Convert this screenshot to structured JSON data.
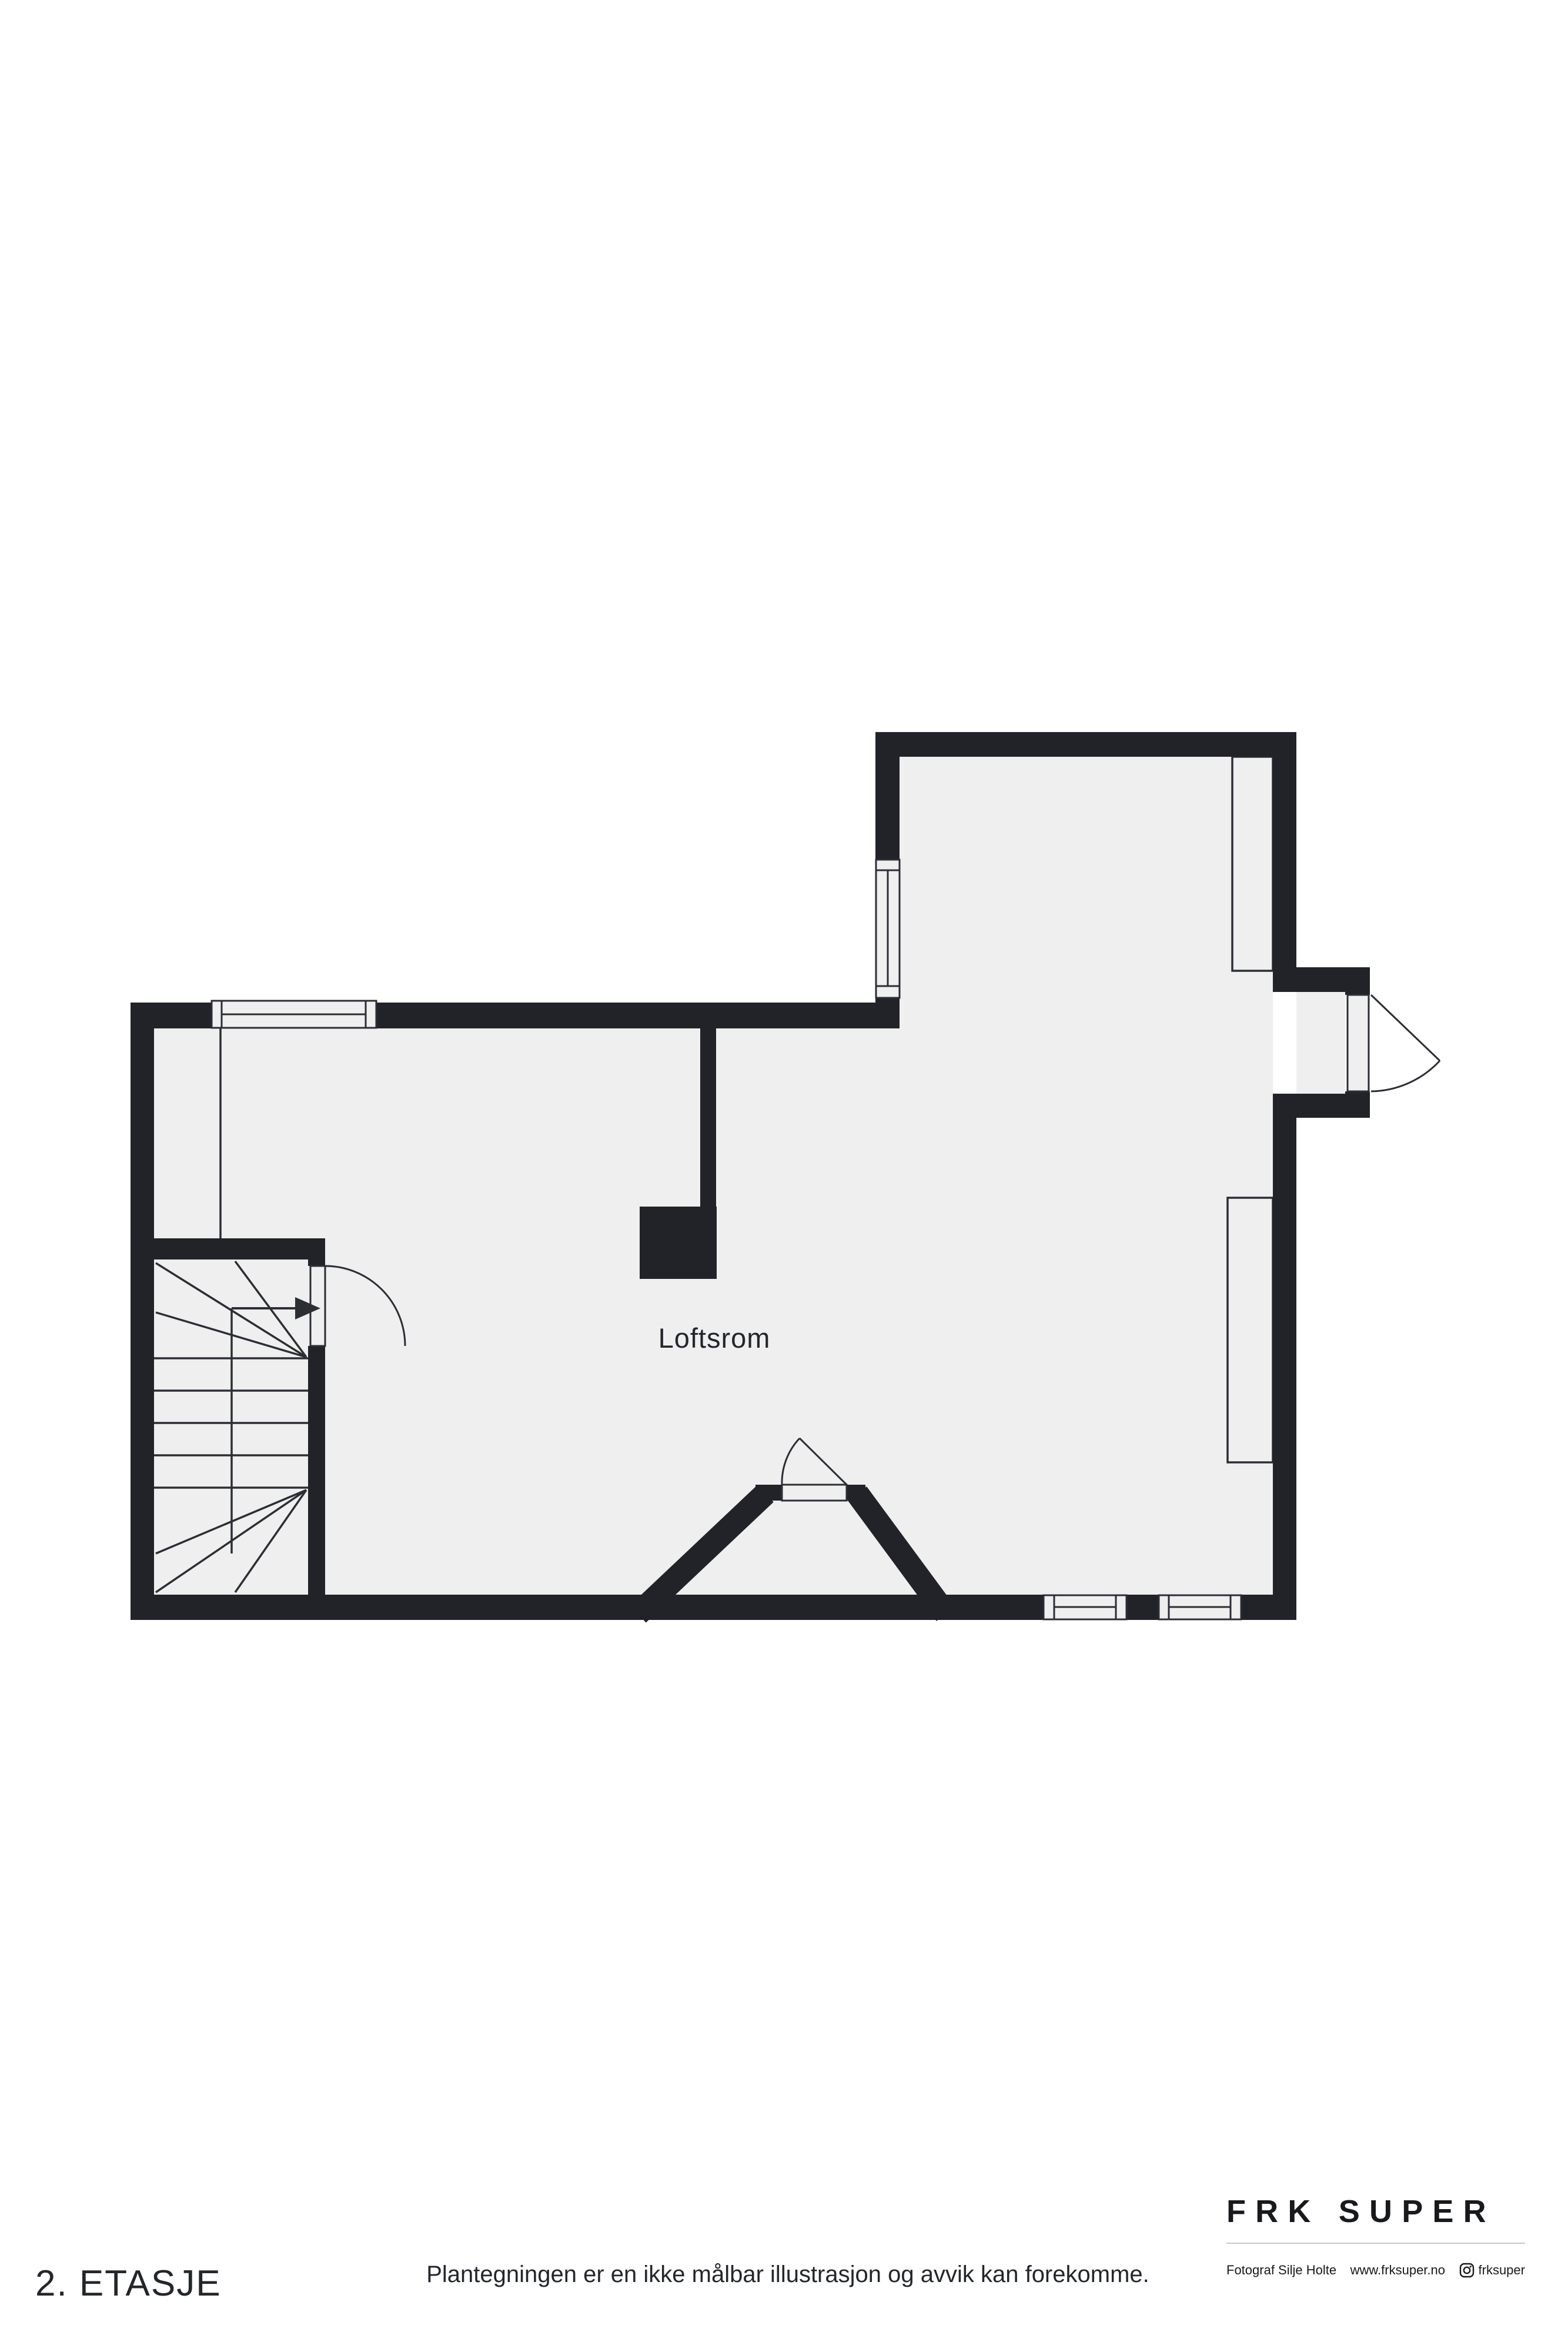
{
  "colors": {
    "wall": "#212329",
    "floor": "#efefef",
    "line": "#2b2e34",
    "background": "#ffffff",
    "text": "#1d2025",
    "rule": "#c8c8c8"
  },
  "floor_plan": {
    "room_label": "Loftsrom",
    "icons": {
      "stair_direction": "arrow-right-icon",
      "door_swings": "quarter-arc-door-symbol"
    }
  },
  "footer": {
    "floor_label": "2. ETASJE",
    "disclaimer": "Plantegningen er en ikke målbar illustrasjon og avvik kan forekomme.",
    "brand": {
      "logo_text": "FRK SUPER",
      "photographer": "Fotograf Silje Holte",
      "website": "www.frksuper.no",
      "instagram_handle": "frksuper"
    }
  }
}
